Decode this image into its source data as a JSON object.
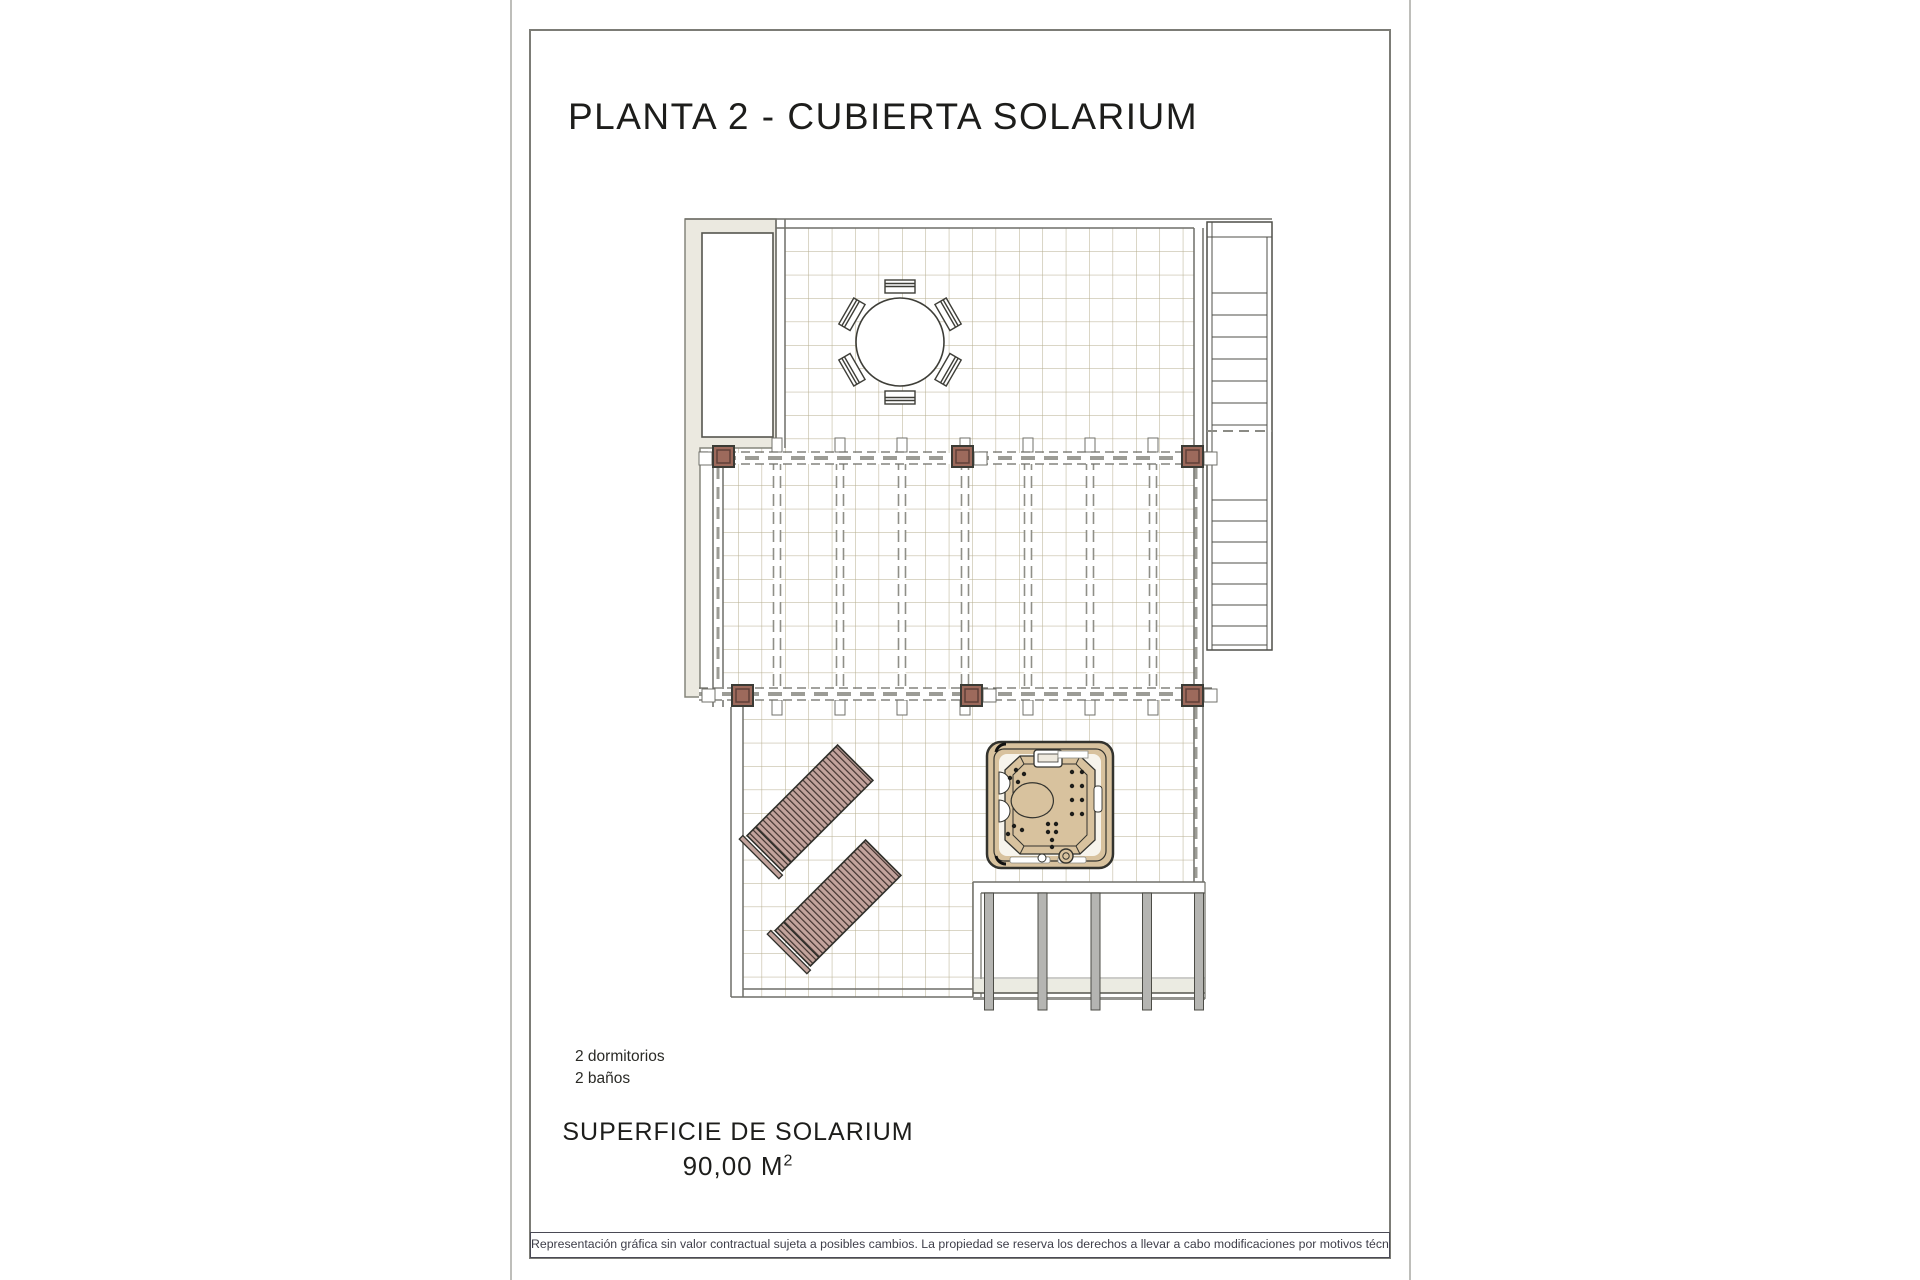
{
  "page": {
    "title": "PLANTA 2 - CUBIERTA SOLARIUM",
    "features": {
      "line1": "2 dormitorios",
      "line2": "2 baños"
    },
    "area": {
      "label": "SUPERFICIE DE SOLARIUM",
      "value": "90,00 M",
      "superscript": "2"
    },
    "disclaimer": "Representación gráfica sin valor contractual sujeta a posibles cambios. La propiedad se reserva los derechos a llevar a cabo modificaciones por motivos técnicos y cumpliendo la normativa vigente."
  },
  "plan": {
    "elements": [
      "roof-terrace",
      "pergola",
      "solarium-terrace",
      "staircase",
      "skylight",
      "dining-table",
      "dining-chairs",
      "sun-loungers",
      "hot-tub",
      "pergola-posts",
      "structural-columns"
    ],
    "colors": {
      "tile_grid": "#b6ad8e",
      "pergola_post": "#9d6a5c",
      "lounger": "#c2a39c",
      "lounger_stripe": "#42332f",
      "hot_tub": "#d8c29e",
      "light_grey_fill": "#ebe9e0",
      "outline": "#55554e",
      "column_grey": "#b5b5b2"
    }
  }
}
